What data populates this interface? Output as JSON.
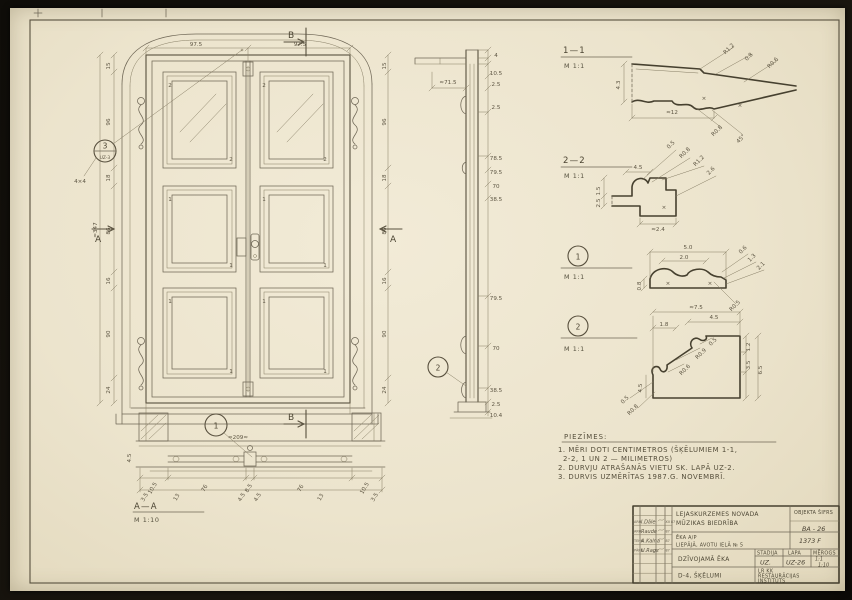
{
  "sheet": {
    "paper_color": "#ece4cd",
    "line_color": "#58503e",
    "type": "architectural measured drawing, double-leaf panelled door with sections and moulding details"
  },
  "sections": {
    "s11": {
      "title": "1—1",
      "scale": "M 1:1"
    },
    "s22": {
      "title": "2—2",
      "scale": "M 1:1"
    },
    "det1": {
      "scale": "M 1:1"
    },
    "det2": {
      "scale": "M 1:1"
    },
    "aa": {
      "title": "A—A",
      "scale": "M 1:10"
    }
  },
  "markers": {
    "a_left": "A",
    "a_right": "A",
    "b_top": "B",
    "b_bottom": "B",
    "bubble3_num": "3",
    "bubble3_sheet": "UZ-3",
    "plan_bubble": "1",
    "strip_bubble": "2",
    "det1_bubble": "1",
    "det2_bubble": "2"
  },
  "notes": {
    "title": "PIEZĪMES:",
    "lines": [
      "1. MĒRI DOTI CENTIMETROS (ŠĶĒLUMIEM 1-1,",
      "2-2, 1 UN 2 — MILIMETROS)",
      "2. DURVJU ATRAŠANĀS VIETU SK. LAPĀ UZ-2.",
      "3. DURVIS UZMĒRĪTAS 1987.G. NOVEMBRĪ."
    ]
  },
  "titleblock": {
    "org_line1": "LEJASKURZEMES NOVADA",
    "org_line2": "MŪZIKAS BIEDRĪBA",
    "objekta_sifrs_label": "OBJEKTA ŠIFRS",
    "objekta_sifrs": "BA - 26",
    "building_line1": "ĒKA A/P",
    "building_line2": "LIEPĀJĀ, AVOTU IELĀ № 5",
    "doc_no": "1373 F",
    "object_name": "DZĪVOJAMĀ ĒKA",
    "stadija_label": "STADIJA",
    "lapa_label": "LAPA",
    "merogs_label": "MĒROGS",
    "stadija": "UZ.",
    "lapa": "UZ-26",
    "merogs_line1": "1:1",
    "merogs_line2": "1:10",
    "sheet_title": "D-4, ŠĶĒLUMI",
    "institute_line1": "LR KK",
    "institute_line2": "RESTAURĀCIJAS",
    "institute_line3": "INSTITŪTS",
    "signatures": [
      {
        "role": "ARH.",
        "name": "I.Dāle",
        "date": "XII 87"
      },
      {
        "role": "ARH.",
        "name": "Raude",
        "date": "87"
      },
      {
        "role": "TEHN.",
        "name": "A.Kalna",
        "date": "87"
      },
      {
        "role": "PĀRB.",
        "name": "U.Rags",
        "date": "87"
      }
    ]
  },
  "annotations": [
    {
      "x": 110,
      "y": 66,
      "t": "15",
      "r": -90
    },
    {
      "x": 110,
      "y": 122,
      "t": "96",
      "r": -90
    },
    {
      "x": 110,
      "y": 178,
      "t": "18",
      "r": -90
    },
    {
      "x": 110,
      "y": 231,
      "t": "86",
      "r": -90
    },
    {
      "x": 110,
      "y": 281,
      "t": "16",
      "r": -90
    },
    {
      "x": 110,
      "y": 334,
      "t": "90",
      "r": -90
    },
    {
      "x": 110,
      "y": 390,
      "t": "24",
      "r": -90
    },
    {
      "x": 97,
      "y": 230,
      "t": "≈347",
      "r": -90
    },
    {
      "x": 386,
      "y": 66,
      "t": "15",
      "r": -90
    },
    {
      "x": 386,
      "y": 122,
      "t": "96",
      "r": -90
    },
    {
      "x": 386,
      "y": 178,
      "t": "18",
      "r": -90
    },
    {
      "x": 386,
      "y": 231,
      "t": "86",
      "r": -90
    },
    {
      "x": 386,
      "y": 281,
      "t": "16",
      "r": -90
    },
    {
      "x": 386,
      "y": 334,
      "t": "90",
      "r": -90
    },
    {
      "x": 386,
      "y": 390,
      "t": "24",
      "r": -90
    },
    {
      "x": 196,
      "y": 46,
      "t": "97.5"
    },
    {
      "x": 300,
      "y": 46,
      "t": "97.5"
    },
    {
      "x": 170,
      "y": 87,
      "t": "2"
    },
    {
      "x": 231,
      "y": 161,
      "t": "2"
    },
    {
      "x": 264,
      "y": 87,
      "t": "2"
    },
    {
      "x": 325,
      "y": 161,
      "t": "2"
    },
    {
      "x": 170,
      "y": 201,
      "t": "1"
    },
    {
      "x": 231,
      "y": 267,
      "t": "1"
    },
    {
      "x": 264,
      "y": 201,
      "t": "1"
    },
    {
      "x": 325,
      "y": 267,
      "t": "1"
    },
    {
      "x": 170,
      "y": 303,
      "t": "1"
    },
    {
      "x": 231,
      "y": 373,
      "t": "1"
    },
    {
      "x": 264,
      "y": 303,
      "t": "1"
    },
    {
      "x": 325,
      "y": 373,
      "t": "1"
    },
    {
      "x": 80,
      "y": 183,
      "t": "4×4"
    },
    {
      "x": 238,
      "y": 439,
      "t": "≈209≈"
    },
    {
      "x": 154,
      "y": 489,
      "t": "10.5",
      "r": -60
    },
    {
      "x": 206,
      "y": 489,
      "t": "76",
      "r": -60
    },
    {
      "x": 250,
      "y": 489,
      "t": "8.5",
      "r": -60
    },
    {
      "x": 302,
      "y": 489,
      "t": "76",
      "r": -60
    },
    {
      "x": 366,
      "y": 489,
      "t": "10.5",
      "r": -60
    },
    {
      "x": 146,
      "y": 498,
      "t": "3.5",
      "r": -60
    },
    {
      "x": 178,
      "y": 498,
      "t": "13",
      "r": -60
    },
    {
      "x": 243,
      "y": 498,
      "t": "4.5",
      "r": -60
    },
    {
      "x": 259,
      "y": 498,
      "t": "4.5",
      "r": -60
    },
    {
      "x": 322,
      "y": 498,
      "t": "13",
      "r": -60
    },
    {
      "x": 376,
      "y": 498,
      "t": "3.5",
      "r": -60
    },
    {
      "x": 131,
      "y": 458,
      "t": "4.5",
      "r": -90
    },
    {
      "x": 448,
      "y": 84,
      "t": "≈71.5"
    },
    {
      "x": 496,
      "y": 57,
      "t": "4"
    },
    {
      "x": 496,
      "y": 75,
      "t": "10.5"
    },
    {
      "x": 496,
      "y": 86,
      "t": "2.5"
    },
    {
      "x": 496,
      "y": 109,
      "t": "2.5"
    },
    {
      "x": 496,
      "y": 160,
      "t": "78.5"
    },
    {
      "x": 496,
      "y": 174,
      "t": "79.5"
    },
    {
      "x": 496,
      "y": 188,
      "t": "70"
    },
    {
      "x": 496,
      "y": 201,
      "t": "38.5"
    },
    {
      "x": 496,
      "y": 300,
      "t": "79.5"
    },
    {
      "x": 496,
      "y": 350,
      "t": "70"
    },
    {
      "x": 496,
      "y": 392,
      "t": "38.5"
    },
    {
      "x": 496,
      "y": 406,
      "t": "2.5"
    },
    {
      "x": 496,
      "y": 417,
      "t": "10.4"
    },
    {
      "x": 620,
      "y": 85,
      "t": "4.3",
      "r": -90
    },
    {
      "x": 730,
      "y": 50,
      "t": "R1.2",
      "r": -45
    },
    {
      "x": 750,
      "y": 58,
      "t": "0.8",
      "r": -45
    },
    {
      "x": 774,
      "y": 64,
      "t": "R0.6",
      "r": -45
    },
    {
      "x": 672,
      "y": 114,
      "t": "≈12"
    },
    {
      "x": 718,
      "y": 132,
      "t": "R0.8",
      "r": -45
    },
    {
      "x": 742,
      "y": 140,
      "t": "45°",
      "r": -45
    },
    {
      "x": 704,
      "y": 100,
      "t": "×"
    },
    {
      "x": 740,
      "y": 107,
      "t": "×"
    },
    {
      "x": 638,
      "y": 169,
      "t": "4.5"
    },
    {
      "x": 600,
      "y": 191,
      "t": "1.5",
      "r": -90
    },
    {
      "x": 600,
      "y": 203,
      "t": "2.5",
      "r": -90
    },
    {
      "x": 672,
      "y": 146,
      "t": "0.5",
      "r": -45
    },
    {
      "x": 686,
      "y": 154,
      "t": "R0.8",
      "r": -45
    },
    {
      "x": 700,
      "y": 162,
      "t": "R1.2",
      "r": -45
    },
    {
      "x": 712,
      "y": 172,
      "t": "2.6",
      "r": -45
    },
    {
      "x": 658,
      "y": 231,
      "t": "≈2.4"
    },
    {
      "x": 664,
      "y": 209,
      "t": "×"
    },
    {
      "x": 688,
      "y": 249,
      "t": "5.0"
    },
    {
      "x": 684,
      "y": 259,
      "t": "2.0"
    },
    {
      "x": 641,
      "y": 286,
      "t": "0.8",
      "r": -90
    },
    {
      "x": 744,
      "y": 251,
      "t": "0.6",
      "r": -45
    },
    {
      "x": 753,
      "y": 259,
      "t": "1.3",
      "r": -45
    },
    {
      "x": 762,
      "y": 267,
      "t": "2.1",
      "r": -45
    },
    {
      "x": 736,
      "y": 307,
      "t": "R0.5",
      "r": -45
    },
    {
      "x": 668,
      "y": 285,
      "t": "×"
    },
    {
      "x": 710,
      "y": 285,
      "t": "×"
    },
    {
      "x": 696,
      "y": 309,
      "t": "≈7.5"
    },
    {
      "x": 714,
      "y": 319,
      "t": "4.5"
    },
    {
      "x": 664,
      "y": 326,
      "t": "1.8"
    },
    {
      "x": 750,
      "y": 347,
      "t": "1.2",
      "r": -90
    },
    {
      "x": 750,
      "y": 365,
      "t": "3.5",
      "r": -90
    },
    {
      "x": 762,
      "y": 370,
      "t": "6.5",
      "r": -90
    },
    {
      "x": 702,
      "y": 355,
      "t": "R0.9",
      "r": -45
    },
    {
      "x": 686,
      "y": 371,
      "t": "R0.6",
      "r": -45
    },
    {
      "x": 714,
      "y": 343,
      "t": "0.5",
      "r": -45
    },
    {
      "x": 634,
      "y": 411,
      "t": "R0.8",
      "r": -45
    },
    {
      "x": 626,
      "y": 401,
      "t": "0.5",
      "r": -45
    },
    {
      "x": 642,
      "y": 388,
      "t": "4.5",
      "r": -90
    }
  ]
}
